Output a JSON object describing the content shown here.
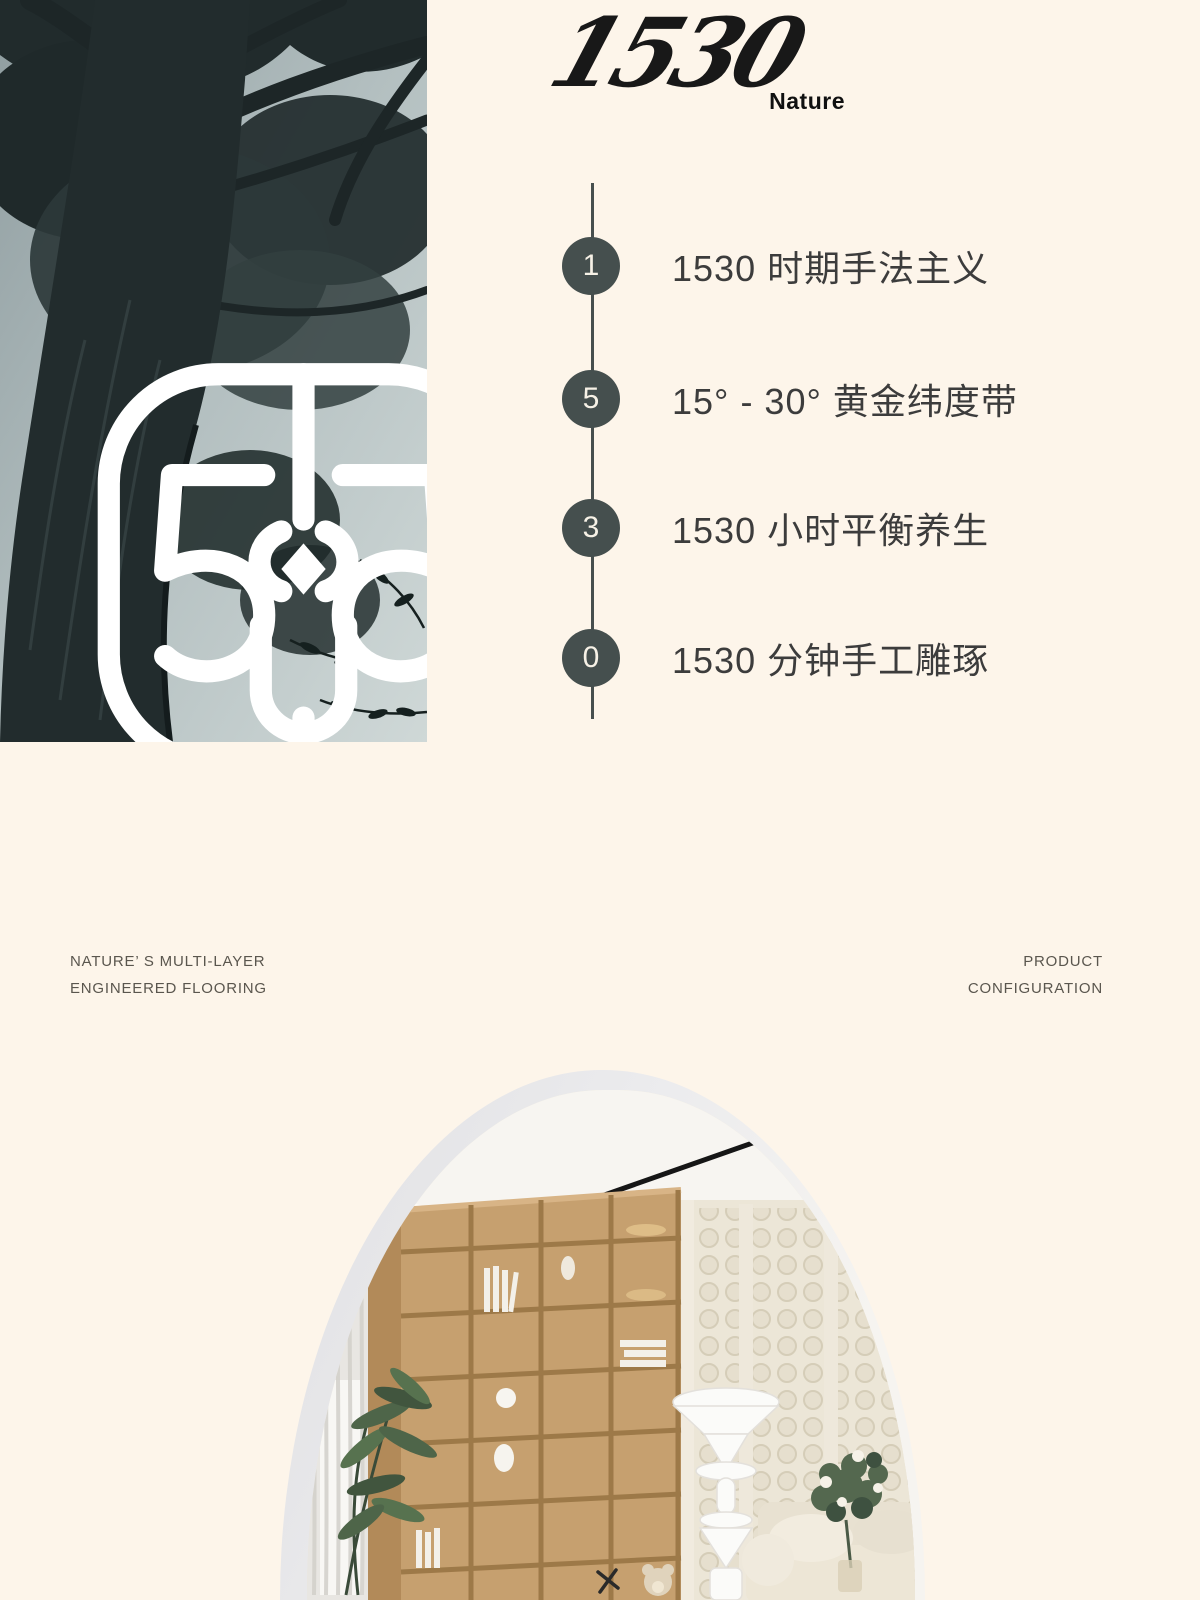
{
  "page": {
    "background_color": "#fdf5ea",
    "width": 1200,
    "height": 1600
  },
  "brand": {
    "logo_number": "1530",
    "logo_name": "Nature",
    "emblem_monogram": "1530"
  },
  "timeline": {
    "node_color": "#454f4e",
    "line_color": "#474f4e",
    "items": [
      {
        "digit": "1",
        "label": "1530 时期手法主义"
      },
      {
        "digit": "5",
        "label": "15° - 30° 黄金纬度带"
      },
      {
        "digit": "3",
        "label": "1530 小时平衡养生"
      },
      {
        "digit": "0",
        "label": "1530 分钟手工雕琢"
      }
    ]
  },
  "captions": {
    "left": {
      "line1": "NATURE’ S MULTI-LAYER",
      "line2": "ENGINEERED FLOORING"
    },
    "right": {
      "line1": "PRODUCT",
      "line2": "CONFIGURATION"
    }
  },
  "photos": {
    "tree": "monochrome upward view of tall tree",
    "interior": "arched living room with oak bookshelf, dotted wall panels, sculptural lamp and beige sofa"
  }
}
